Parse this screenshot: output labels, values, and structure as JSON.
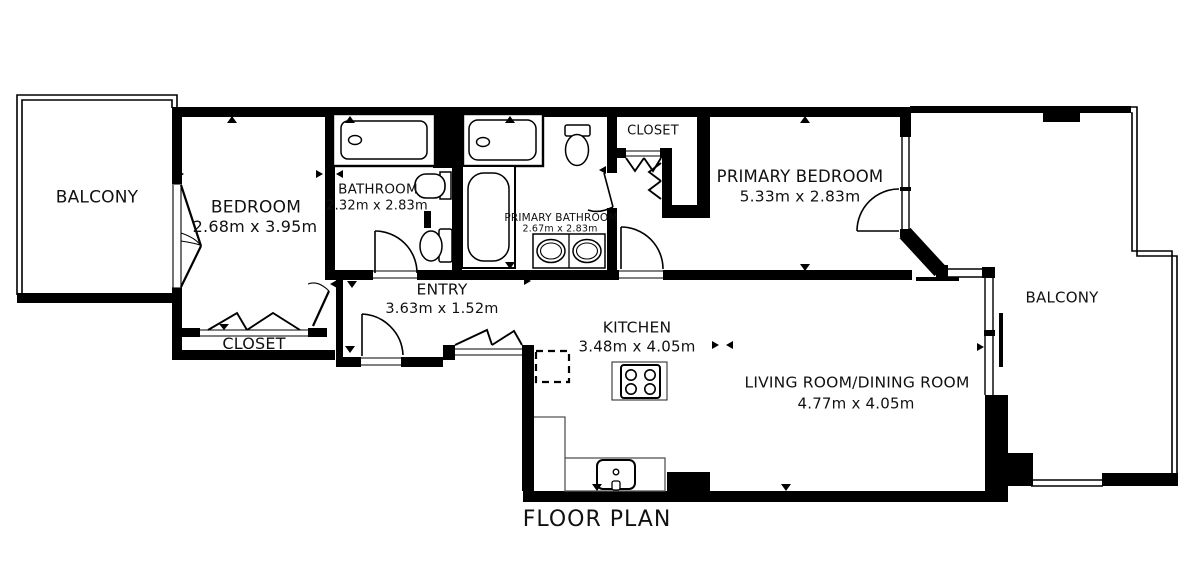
{
  "title": "FLOOR PLAN",
  "rooms": {
    "balcony_left": {
      "name": "BALCONY"
    },
    "bedroom": {
      "name": "BEDROOM",
      "dims": "2.68m x 3.95m"
    },
    "closet_left": {
      "name": "CLOSET"
    },
    "bathroom": {
      "name": "BATHROOM",
      "dims": "2.32m x 2.83m"
    },
    "primary_bathroom": {
      "name": "PRIMARY BATHROOM",
      "dims": "2.67m x 2.83m"
    },
    "closet_hall": {
      "name": "CLOSET"
    },
    "primary_bedroom": {
      "name": "PRIMARY BEDROOM",
      "dims": "5.33m x 2.83m"
    },
    "entry": {
      "name": "ENTRY",
      "dims": "3.63m x 1.52m"
    },
    "kitchen": {
      "name": "KITCHEN",
      "dims": "3.48m x 4.05m"
    },
    "living_dining": {
      "name": "LIVING ROOM/DINING ROOM",
      "dims": "4.77m x 4.05m"
    },
    "balcony_right": {
      "name": "BALCONY"
    }
  },
  "colors": {
    "wall": "#000000",
    "background": "#ffffff",
    "text": "#111111"
  }
}
